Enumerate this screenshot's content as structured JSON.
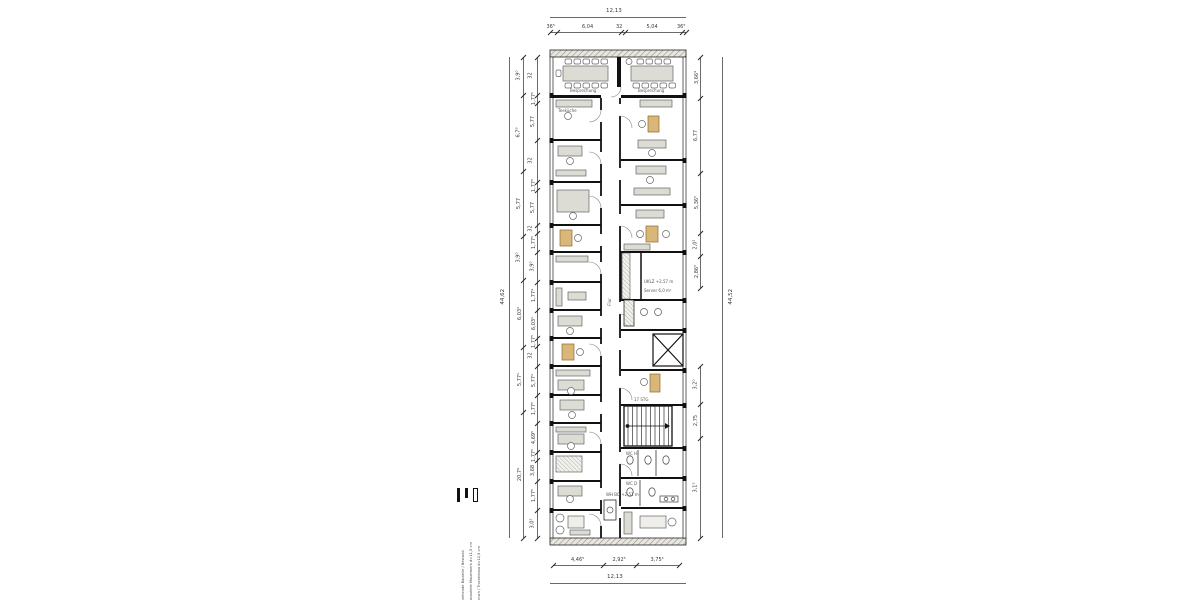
{
  "drawing": {
    "kind": "architectural floor plan, long narrow office building, vertical orientation"
  },
  "dims": {
    "top": {
      "total": "12,13",
      "segments": [
        "36⁵",
        "6,04",
        "32",
        "5,04",
        "36⁵"
      ]
    },
    "bottom": {
      "total": "12,13",
      "segments": [
        "4,46⁵",
        "2,92⁵",
        "3,75⁴"
      ]
    },
    "left": {
      "total": "44,62",
      "outer": [
        "3,9⁰",
        "6,7⁹",
        "5,77",
        "3,9⁰",
        "6,03¹",
        "5,77¹",
        "20,7⁹"
      ],
      "inner": [
        "32",
        "1,77⁵",
        "5,77",
        "32",
        "1,77⁵",
        "5,77",
        "32",
        "1,77⁵",
        "3,9⁰",
        "1,77⁴",
        "6,03¹",
        "1,77⁵",
        "32",
        "5,77¹",
        "1,77⁵",
        "4,69⁵",
        "1,77⁵",
        "3,68",
        "1,77⁵",
        "3,0⁵"
      ]
    },
    "right": {
      "total": "44,52",
      "upper": [
        "3,66⁴",
        "6,77",
        "5,36⁵",
        "2,0²",
        "2,86⁵"
      ],
      "lower": [
        "3,2⁰",
        "2,75",
        "3,1⁵"
      ]
    }
  },
  "rooms": {
    "meeting_left": "Besprechung",
    "meeting_right": "Besprechung",
    "tea": "Teeküche",
    "server_note": "UKLZ +2,57 m",
    "server": "Server 6,0 m²",
    "corridor": "Flur",
    "stair_note": "17 STG",
    "note_center": "WH BO +2,51 m",
    "wc_h": "WC H",
    "wc_d": "WC D"
  },
  "legend": {
    "items": [
      {
        "label": "Bestehende Bauteile / Bestand"
      },
      {
        "label": "Neubauteile Mauerwerk d=11,5 cm"
      },
      {
        "label": "Abbruch / Trockenbau d=12,5 cm"
      }
    ]
  },
  "colors": {
    "wall": "#1c1c1c",
    "hatch_fill": "#e8e6df",
    "furniture_gray": "#dcdcd4",
    "furniture_tan": "#d9b778",
    "dim_line": "#6a6a6a",
    "dim_text": "#3a3a3a"
  }
}
